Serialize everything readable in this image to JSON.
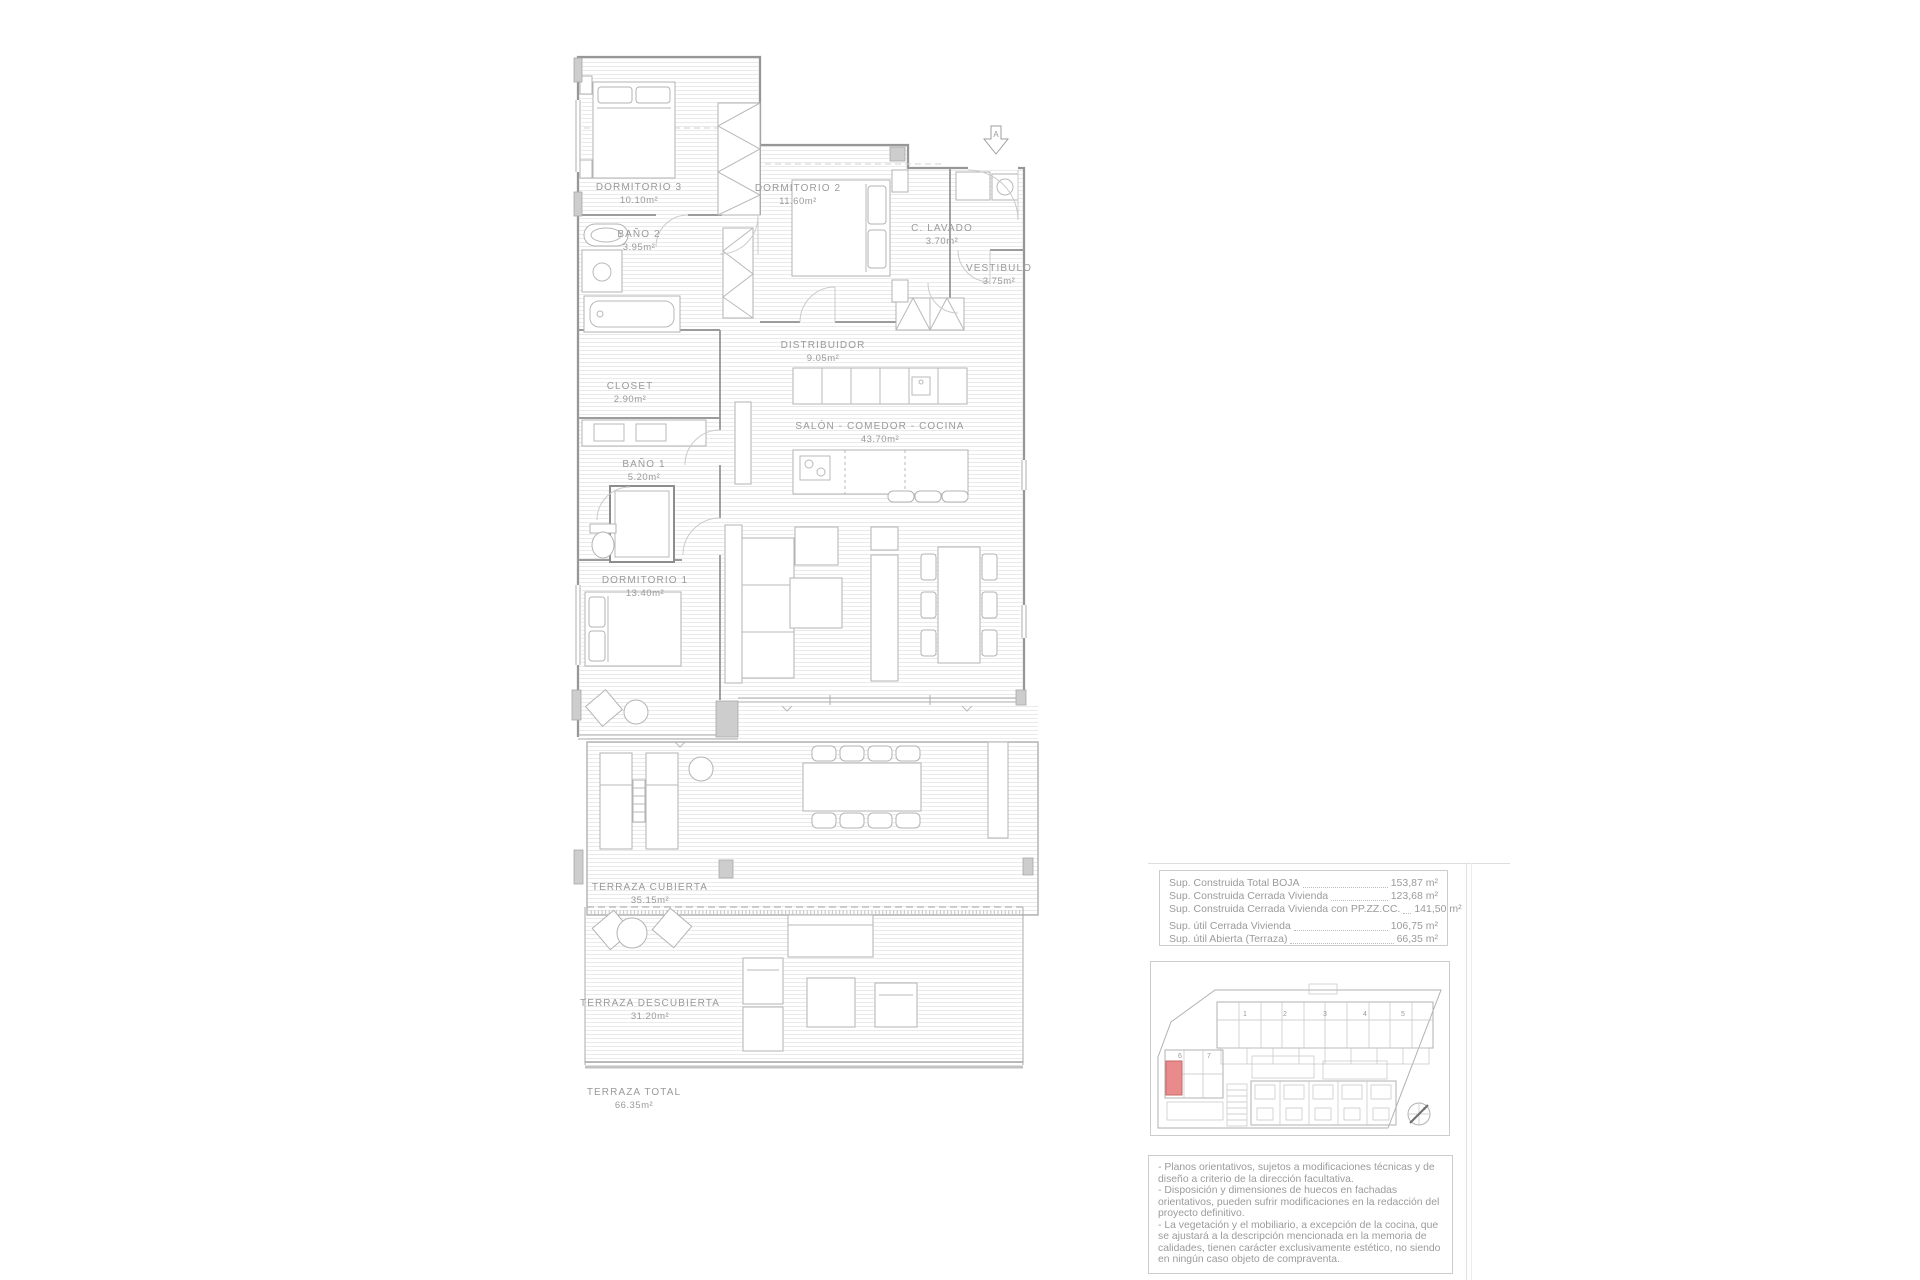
{
  "floor_plan": {
    "section_marker": "A",
    "rooms": [
      {
        "name": "DORMITORIO 3",
        "area": "10.10m²"
      },
      {
        "name": "DORMITORIO 2",
        "area": "11.60m²"
      },
      {
        "name": "BAÑO 2",
        "area": "3.95m²"
      },
      {
        "name": "C. LAVADO",
        "area": "3.70m²"
      },
      {
        "name": "VESTIBULO",
        "area": "3.75m²"
      },
      {
        "name": "DISTRIBUIDOR",
        "area": "9.05m²"
      },
      {
        "name": "CLOSET",
        "area": "2.90m²"
      },
      {
        "name": "SALÓN - COMEDOR - COCINA",
        "area": "43.70m²"
      },
      {
        "name": "BAÑO 1",
        "area": "5.20m²"
      },
      {
        "name": "DORMITORIO 1",
        "area": "13.40m²"
      },
      {
        "name": "TERRAZA CUBIERTA",
        "area": "35.15m²"
      },
      {
        "name": "TERRAZA DESCUBIERTA",
        "area": "31.20m²"
      },
      {
        "name": "TERRAZA TOTAL",
        "area": "66.35m²"
      }
    ]
  },
  "areas_table": {
    "rows": [
      {
        "label": "Sup. Construida Total BOJA",
        "value": "153,87 m²"
      },
      {
        "label": "Sup. Construida Cerrada Vivienda",
        "value": "123,68 m²"
      },
      {
        "label": "Sup. Construida Cerrada Vivienda con PP.ZZ.CC.",
        "value": "141,50 m²"
      },
      {
        "label": "Sup. útil Cerrada Vivienda",
        "value": "106,75 m²"
      },
      {
        "label": "Sup. útil Abierta (Terraza)",
        "value": "66,35 m²"
      }
    ]
  },
  "site_plan": {
    "units": [
      "1",
      "2",
      "3",
      "4",
      "5",
      "6",
      "7"
    ],
    "highlight_color": "#e98b8b"
  },
  "disclaimer": {
    "lines": [
      "- Planos orientativos, sujetos a modificaciones técnicas y de diseño a criterio de la dirección facultativa.",
      "- Disposición y dimensiones de huecos en fachadas orientativos, pueden sufrir modificaciones en la redacción del proyecto definitivo.",
      "- La vegetación y el mobiliario, a excepción de la cocina, que se ajustará a la descripción mencionada en la memoria de calidades, tienen carácter exclusivamente estético, no siendo en ningún caso objeto de compraventa."
    ]
  },
  "colors": {
    "line": "#a6a6a6",
    "text": "#9b9b9b",
    "hatch": "#eaeaea",
    "highlight": "#e98b8b"
  }
}
